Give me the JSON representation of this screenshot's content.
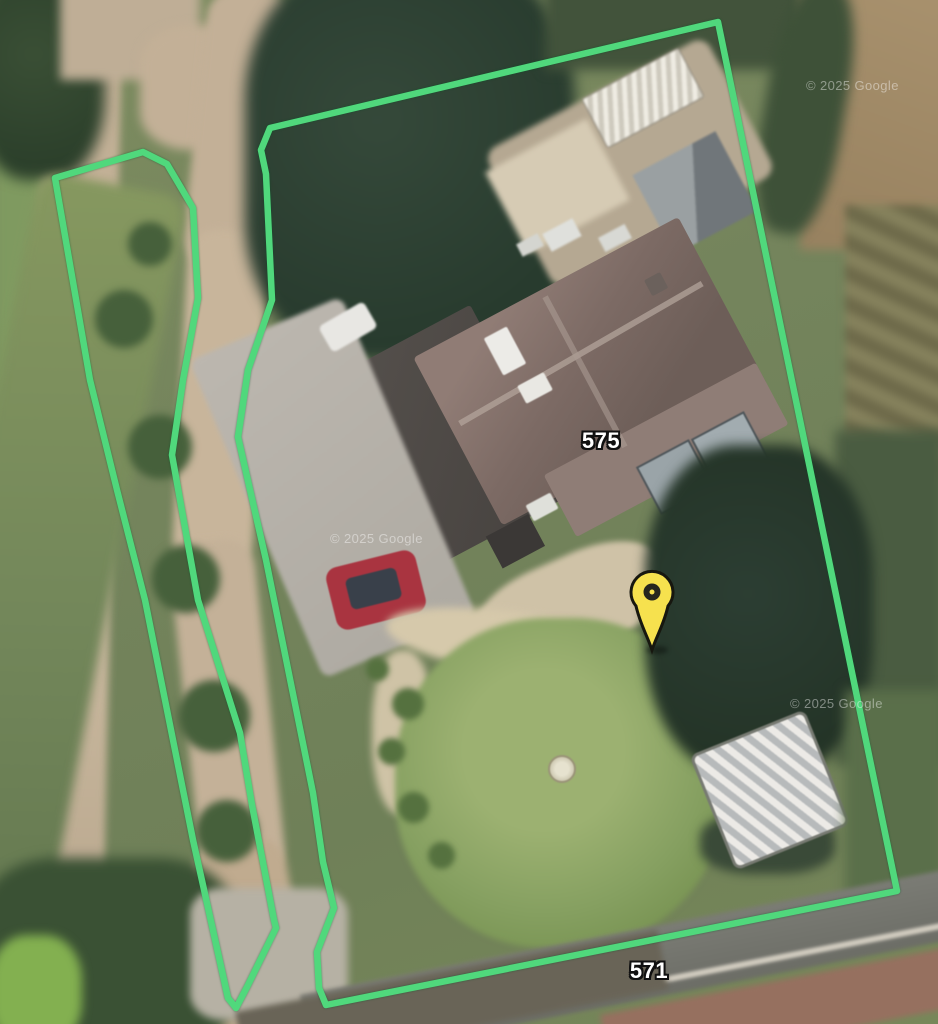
{
  "map": {
    "view_type": "satellite-aerial",
    "attribution": "© 2025 Google",
    "labels": [
      {
        "id": "house-number-575",
        "text": "575",
        "x": 601,
        "y": 441
      },
      {
        "id": "house-number-571",
        "text": "571",
        "x": 649,
        "y": 971
      }
    ],
    "watermarks": [
      {
        "text": "© 2025 Google",
        "x": 330,
        "y": 531
      },
      {
        "text": "© 2025 Google",
        "x": 806,
        "y": 78
      },
      {
        "text": "© 2025 Google",
        "x": 790,
        "y": 696
      }
    ],
    "marker": {
      "name": "property-pin",
      "x": 652,
      "y": 650,
      "fill_color": "#f6e14e",
      "outline_color": "#17170f",
      "inner_color": "#26261e"
    },
    "boundary": {
      "color": "#50d87c",
      "stroke_width": 6.5,
      "polygons": [
        {
          "name": "main-parcel",
          "points": [
            [
              718,
              22
            ],
            [
              270,
              128
            ],
            [
              261,
              150
            ],
            [
              266,
              174
            ],
            [
              272,
              300
            ],
            [
              248,
              370
            ],
            [
              238,
              437
            ],
            [
              266,
              560
            ],
            [
              313,
              793
            ],
            [
              323,
              862
            ],
            [
              334,
              908
            ],
            [
              317,
              952
            ],
            [
              319,
              988
            ],
            [
              326,
              1005
            ],
            [
              897,
              891
            ]
          ]
        },
        {
          "name": "verge-strip",
          "points": [
            [
              55,
              178
            ],
            [
              143,
              152
            ],
            [
              167,
              164
            ],
            [
              193,
              208
            ],
            [
              198,
              298
            ],
            [
              183,
              380
            ],
            [
              172,
              455
            ],
            [
              198,
              600
            ],
            [
              240,
              733
            ],
            [
              252,
              805
            ],
            [
              274,
              920
            ],
            [
              276,
              928
            ],
            [
              247,
              987
            ],
            [
              236,
              1008
            ],
            [
              228,
              998
            ],
            [
              193,
              840
            ],
            [
              145,
              600
            ],
            [
              117,
              490
            ],
            [
              90,
              380
            ]
          ]
        }
      ]
    }
  }
}
